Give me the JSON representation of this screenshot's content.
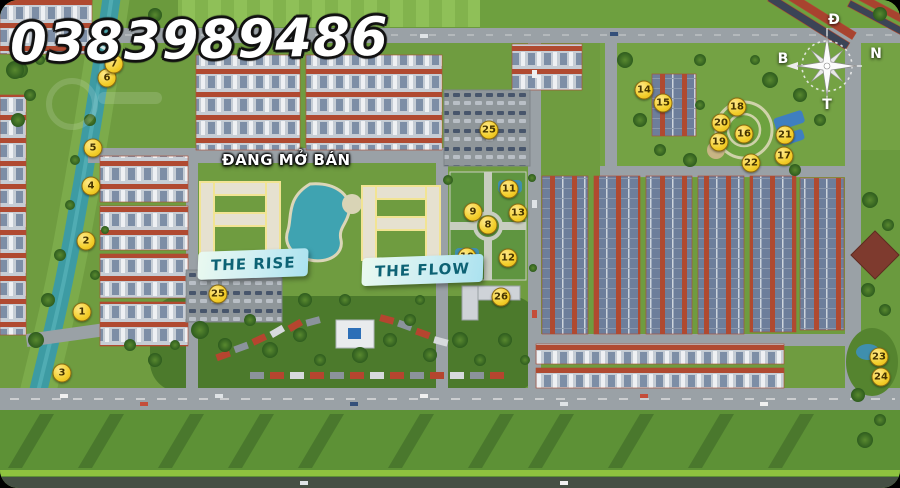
{
  "overlay": {
    "phone_number": "0383989486",
    "sales_status_label": "ĐANG MỞ BÁN",
    "zone_labels": [
      {
        "id": "the-rise",
        "text": "THE RISE"
      },
      {
        "id": "the-flow",
        "text": "THE FLOW"
      }
    ]
  },
  "compass": {
    "top": "Đ",
    "right": "N",
    "left": "B",
    "bottom": "T"
  },
  "markers": [
    {
      "label": "1",
      "x": 82,
      "y": 312
    },
    {
      "label": "2",
      "x": 86,
      "y": 241
    },
    {
      "label": "3",
      "x": 62,
      "y": 373
    },
    {
      "label": "4",
      "x": 91,
      "y": 186
    },
    {
      "label": "5",
      "x": 93,
      "y": 148
    },
    {
      "label": "6",
      "x": 107,
      "y": 78
    },
    {
      "label": "7",
      "x": 114,
      "y": 64
    },
    {
      "label": "8",
      "x": 488,
      "y": 225
    },
    {
      "label": "9",
      "x": 473,
      "y": 212
    },
    {
      "label": "10",
      "x": 467,
      "y": 257
    },
    {
      "label": "11",
      "x": 509,
      "y": 189
    },
    {
      "label": "12",
      "x": 508,
      "y": 258
    },
    {
      "label": "13",
      "x": 518,
      "y": 213
    },
    {
      "label": "14",
      "x": 644,
      "y": 90
    },
    {
      "label": "15",
      "x": 663,
      "y": 103
    },
    {
      "label": "16",
      "x": 744,
      "y": 134
    },
    {
      "label": "17",
      "x": 784,
      "y": 156
    },
    {
      "label": "18",
      "x": 737,
      "y": 107
    },
    {
      "label": "19",
      "x": 719,
      "y": 142
    },
    {
      "label": "20",
      "x": 721,
      "y": 123
    },
    {
      "label": "21",
      "x": 785,
      "y": 135
    },
    {
      "label": "22",
      "x": 751,
      "y": 163
    },
    {
      "label": "23",
      "x": 879,
      "y": 357
    },
    {
      "label": "24",
      "x": 881,
      "y": 377
    },
    {
      "label": "25",
      "x": 489,
      "y": 130
    },
    {
      "label": "25",
      "x": 218,
      "y": 294
    },
    {
      "label": "26",
      "x": 501,
      "y": 297
    }
  ],
  "colors": {
    "marker_yellow": "#f3ce2a",
    "label_text_teal": "#0d6274",
    "label_bg_cyan": "#cdeef3",
    "river_teal": "#3d9ba3",
    "roof_red": "#b04a31",
    "roof_slate": "#6d7e9b",
    "overlay_text": "#ffffff"
  }
}
